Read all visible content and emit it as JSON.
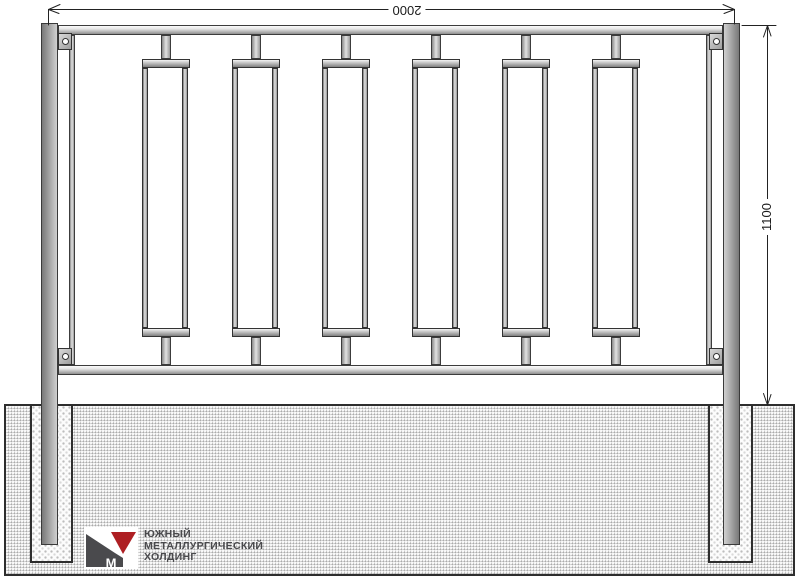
{
  "drawing": {
    "dimensions": {
      "width_label": "2000",
      "height_label": "1100"
    },
    "fence": {
      "picket_count": 6
    }
  },
  "logo": {
    "mark_letter": "M",
    "lines": [
      "ЮЖНЫЙ",
      "МЕТАЛЛУРГИЧЕСКИЙ",
      "ХОЛДИНГ"
    ],
    "colors": {
      "red": "#ae1f23",
      "gray": "#4a4a4d"
    }
  },
  "colors": {
    "line": "#222222",
    "steel_light": "#e7e7e7",
    "steel_dark": "#8f8f8f",
    "ground": "#e4e4e4"
  }
}
